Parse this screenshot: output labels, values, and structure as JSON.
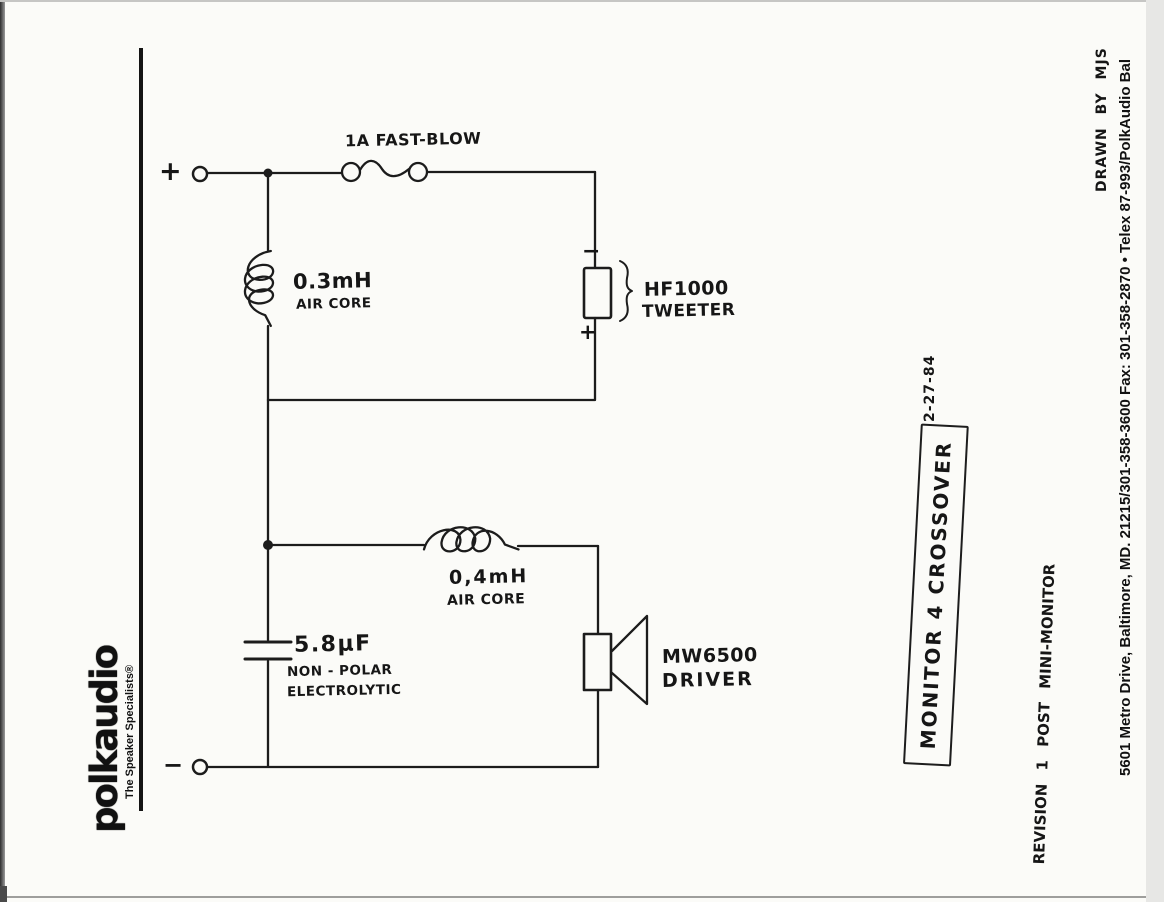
{
  "logo": {
    "wordmark": "polkaudio",
    "tagline": "The Speaker Specialists®"
  },
  "circuit": {
    "input": {
      "plus": "+",
      "minus": "−"
    },
    "fuse": {
      "label": "1A FAST-BLOW"
    },
    "inductor1": {
      "value": "0.3mH",
      "type": "AIR CORE"
    },
    "inductor2": {
      "value": "0,4mH",
      "type": "AIR CORE"
    },
    "capacitor": {
      "value": "5.8µF",
      "desc1": "NON - POLAR",
      "desc2": "ELECTROLYTIC"
    },
    "tweeter": {
      "model": "HF1000",
      "label": "TWEETER",
      "neg": "−",
      "pos": "+"
    },
    "woofer": {
      "model": "MW6500",
      "label": "DRIVER"
    }
  },
  "annotations": {
    "drawn_by": "DRAWN BY MJS",
    "address": "5601 Metro Drive, Baltimore, MD. 21215/301-358-3600 Fax: 301-358-2870 • Telex 87-993/PolkAudio Bal",
    "date": "2-27-84",
    "title": "MONITOR 4 CROSSOVER",
    "revision": "REVISION 1 POST MINI-MONITOR"
  }
}
